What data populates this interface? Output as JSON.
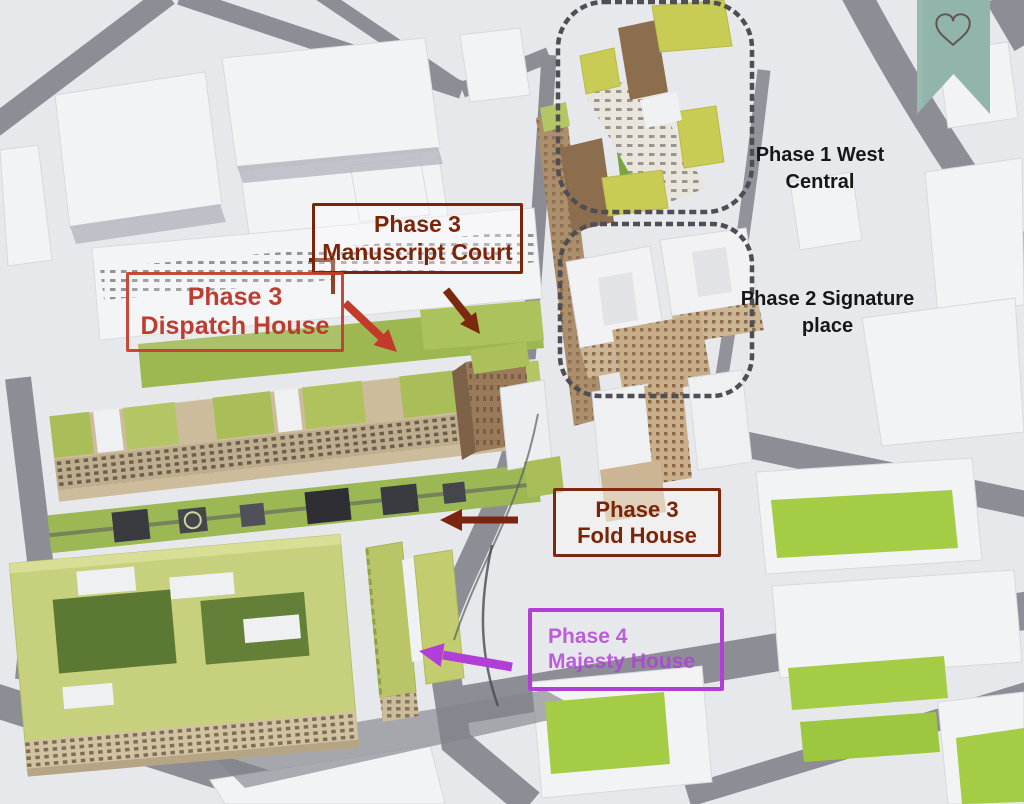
{
  "annotations": {
    "phase1": {
      "line1": "Phase 1",
      "line2": "West Central"
    },
    "phase2": {
      "line1": "Phase 2",
      "line2": "Signature place"
    },
    "manuscript": {
      "line1": "Phase 3",
      "line2": "Manuscript Court"
    },
    "dispatch": {
      "line1": "Phase 3",
      "line2": "Dispatch House"
    },
    "fold": {
      "line1": "Phase 3",
      "line2": "Fold House"
    },
    "majesty": {
      "line1": "Phase 4",
      "line2": "Majesty House"
    }
  },
  "ribbon": {
    "icon_name": "heart",
    "glyph": "♡"
  },
  "colors": {
    "callout_dark_red": "#7b2408",
    "callout_red": "#c23b2a",
    "callout_purple": "#b23ed8",
    "label_black": "#17171a",
    "area_outline_gray": "#4e4e54",
    "ribbon_teal": "#91b4ab",
    "heart_outline": "#635353",
    "lawn_green": "#a5cc45",
    "roof_green": "#a9be58",
    "road_gray": "#8d8d96"
  }
}
